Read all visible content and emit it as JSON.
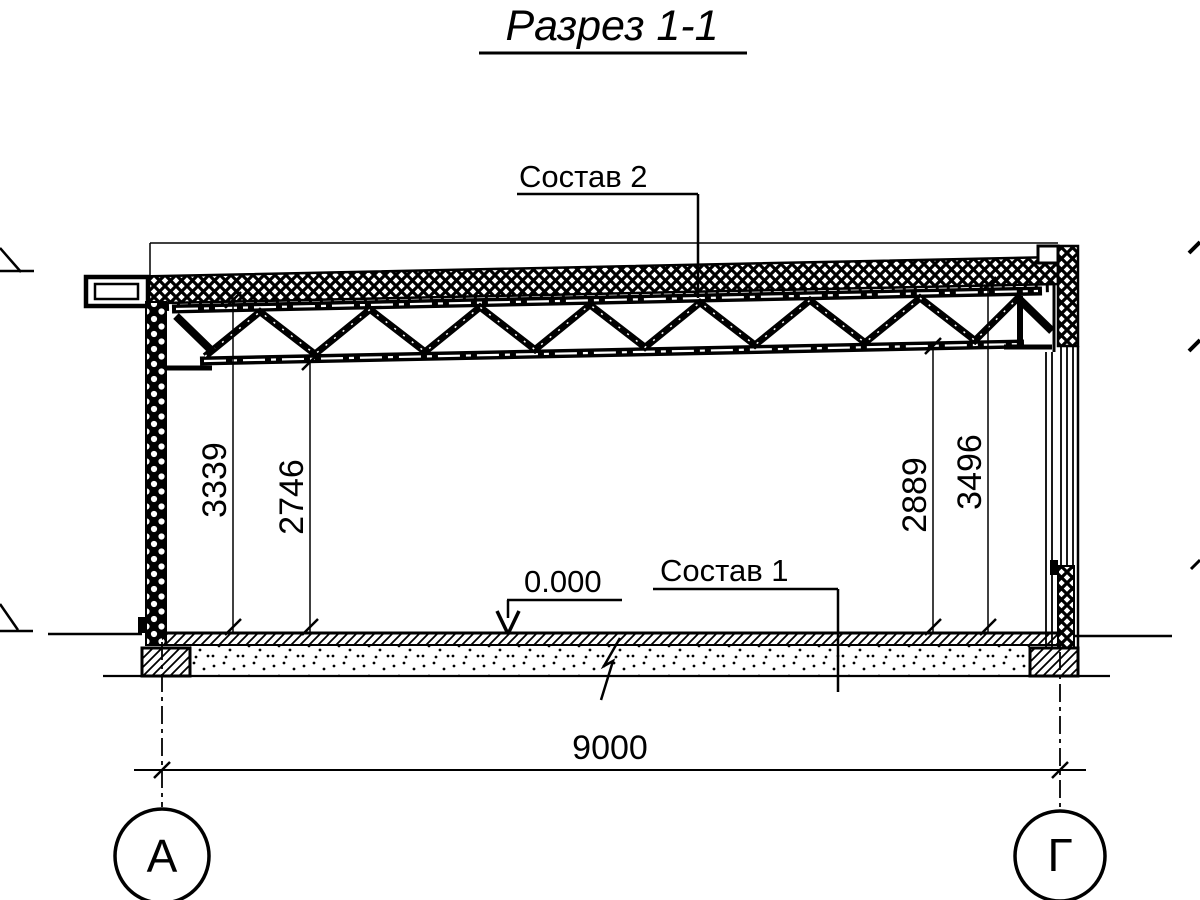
{
  "title": "Разрез 1-1",
  "callouts": {
    "roof_label": "Состав 2",
    "floor_label": "Состав 1",
    "level_mark": "0.000"
  },
  "dimensions": {
    "span": "9000",
    "left_outer": "3339",
    "left_inner": "2746",
    "right_inner": "2889",
    "right_outer": "3496"
  },
  "axes": {
    "left": "А",
    "right": "Г"
  },
  "colors": {
    "ink": "#000000",
    "paper": "#ffffff"
  }
}
